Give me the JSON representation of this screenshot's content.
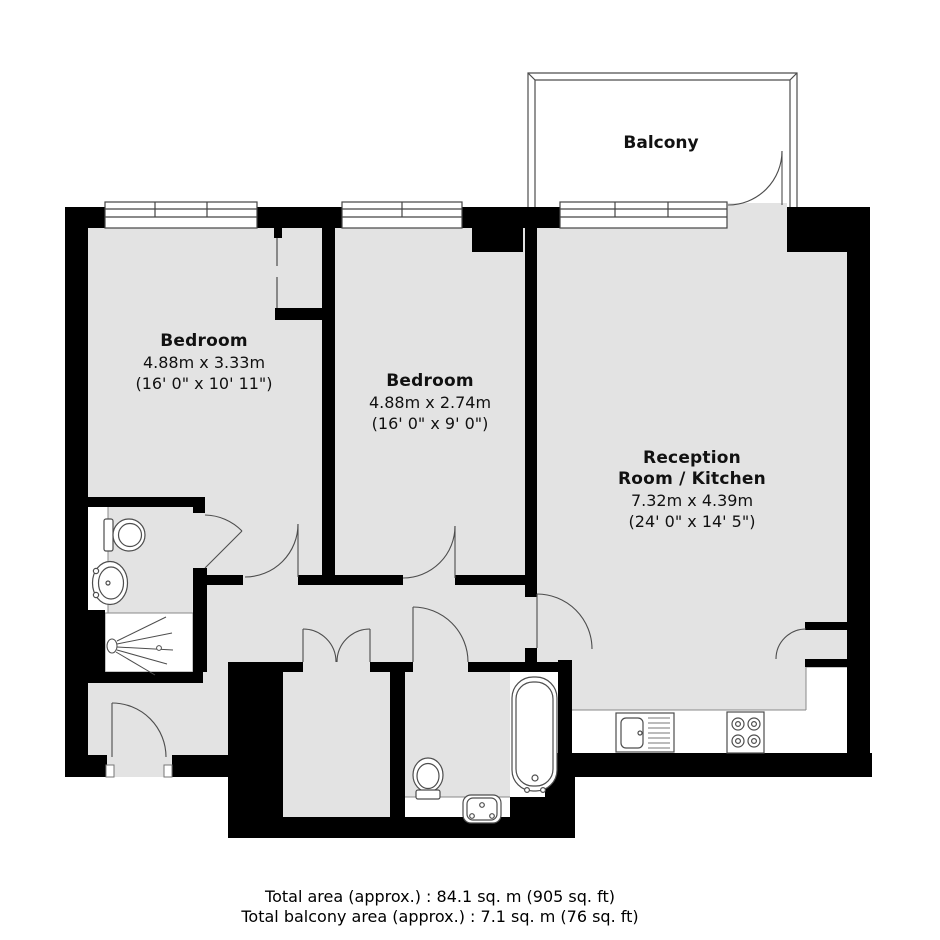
{
  "plan": {
    "rooms": {
      "bedroom1": {
        "name": "Bedroom",
        "dim_metric": "4.88m x 3.33m",
        "dim_imperial": "(16' 0\" x 10' 11\")"
      },
      "bedroom2": {
        "name": "Bedroom",
        "dim_metric": "4.88m x 2.74m",
        "dim_imperial": "(16' 0\" x 9' 0\")"
      },
      "reception": {
        "name_line1": "Reception",
        "name_line2": "Room / Kitchen",
        "dim_metric": "7.32m x 4.39m",
        "dim_imperial": "(24' 0\" x 14' 5\")"
      },
      "balcony": {
        "name": "Balcony"
      }
    },
    "fixtures": {
      "ensuite_shower_room": [
        "toilet",
        "washbasin",
        "shower"
      ],
      "bathroom": [
        "bathtub",
        "toilet",
        "washbasin"
      ],
      "kitchen": [
        "sink-with-drainer",
        "hob",
        "counter"
      ]
    },
    "colors": {
      "floor": "#e3e3e3",
      "wall": "#000000",
      "outline": "#4d4d4d",
      "background": "#ffffff",
      "text": "#111111"
    }
  },
  "footer": {
    "total_area": "Total area (approx.) : 84.1 sq. m (905 sq. ft)",
    "total_balcony_area": "Total balcony area (approx.) : 7.1 sq. m (76 sq. ft)"
  }
}
